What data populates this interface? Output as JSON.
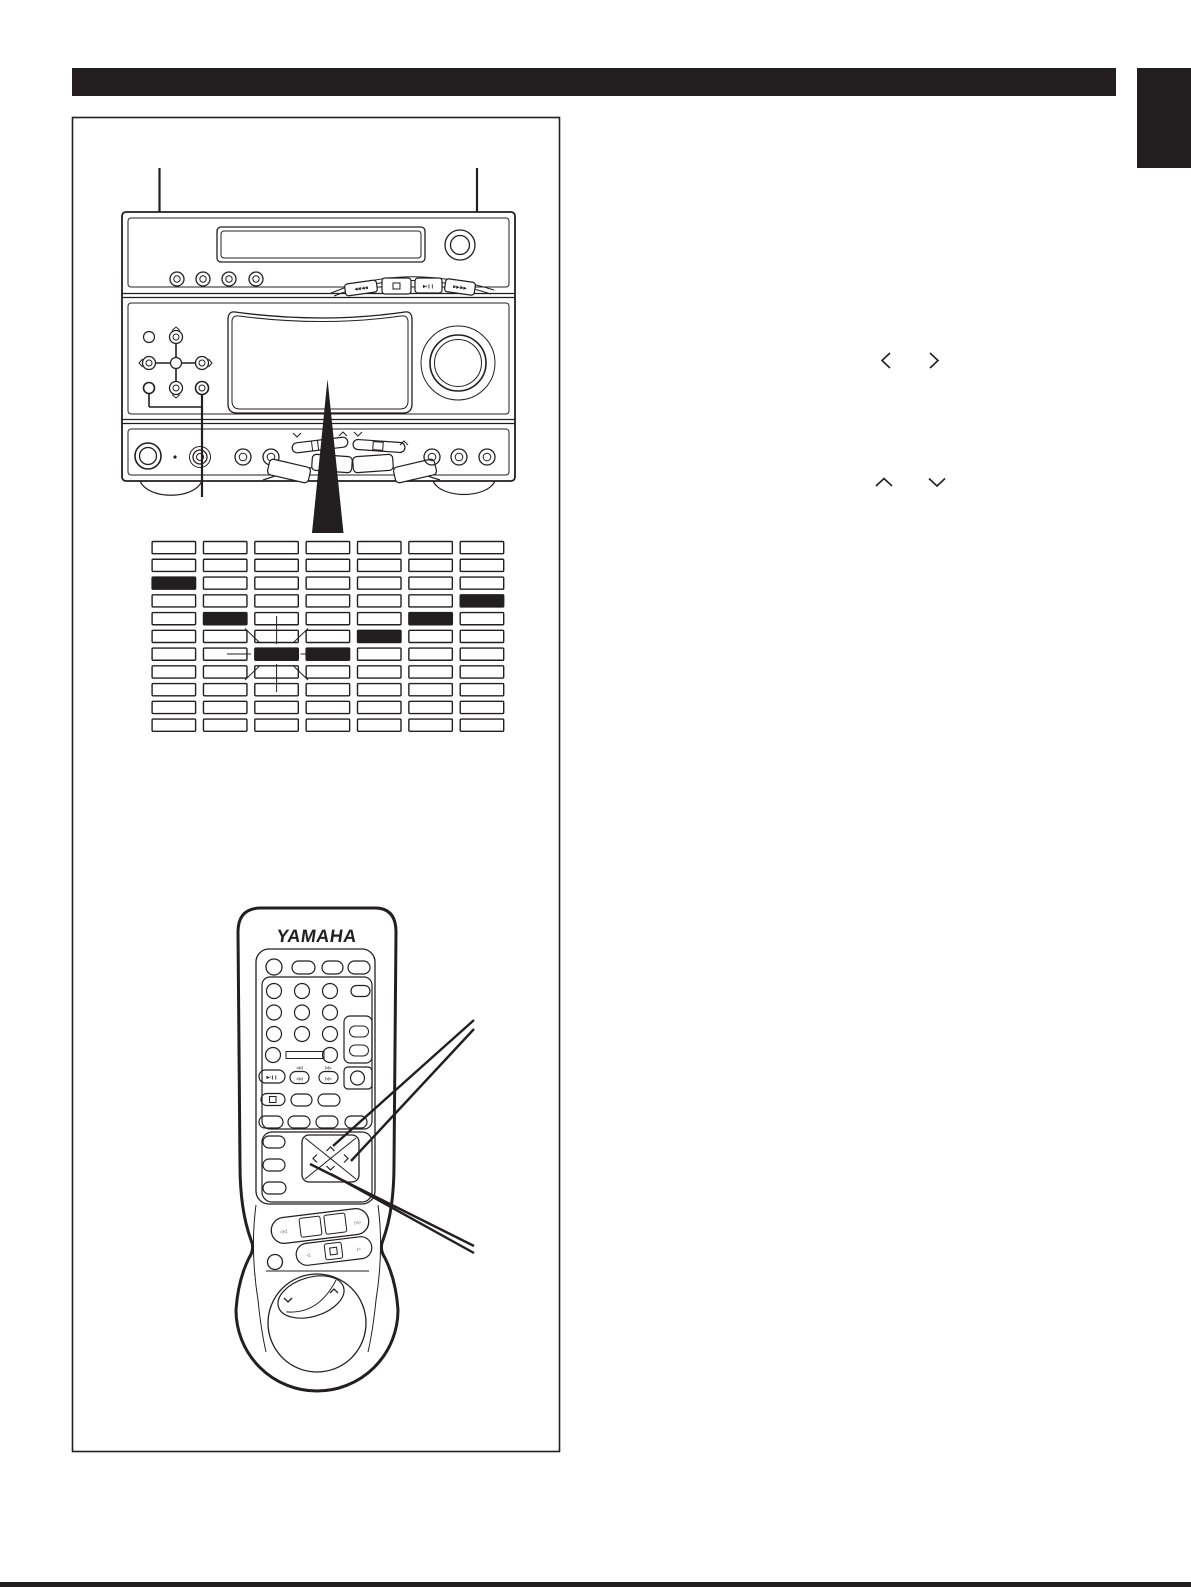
{
  "page": {
    "background": "#ffffff",
    "ink": "#231f20",
    "header_bar_text": "",
    "language_tab_text": ""
  },
  "front_panel": {
    "transport": {
      "rew_label": "◀◀/◀◀",
      "stop_icon": "stop-square",
      "play_pause_label": "▶/❙❙",
      "ff_label": "▶▶/▶▶"
    }
  },
  "display_grid": {
    "type": "heatmap",
    "columns": 7,
    "rows": 11,
    "filled_cells": [
      [
        2,
        0
      ],
      [
        3,
        6
      ],
      [
        4,
        1
      ],
      [
        4,
        5
      ],
      [
        5,
        4
      ],
      [
        6,
        2
      ],
      [
        6,
        3
      ]
    ],
    "blinking_cell": [
      6,
      2
    ]
  },
  "remote": {
    "brand": "YAMAHA",
    "skip_back_label": "◁◁",
    "skip_fwd_label": "▷▷",
    "play_pause_label": "▶/❙❙",
    "prev_label": "◁◁",
    "next_label": "▷▷",
    "tape_rew_label": "◁◁",
    "tape_ff_label": "▷▷",
    "tape_back_label": "◁",
    "tape_fwd_label": "▷"
  },
  "page_glyphs": {
    "left": "〈",
    "right": "〉",
    "up": "∧",
    "down": "∨"
  }
}
